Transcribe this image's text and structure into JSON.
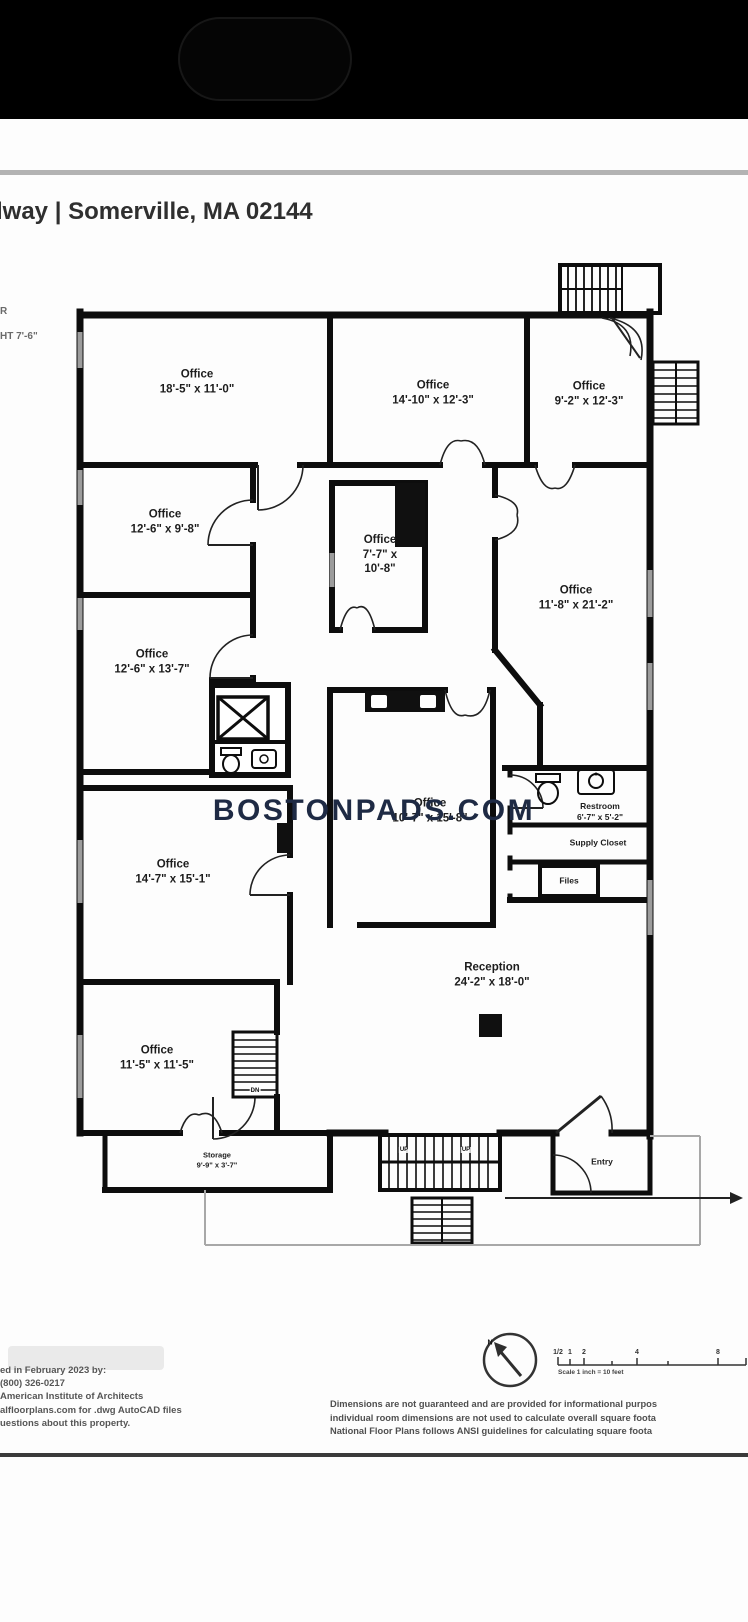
{
  "header": {
    "title": "lway | Somerville, MA 02144",
    "side_note": [
      "R",
      "HT 7'-6\""
    ]
  },
  "watermark": {
    "text": "BOSTONPADS.COM",
    "color": "#1e2a44"
  },
  "rooms": {
    "office1": {
      "name": "Office",
      "dims": "18'-5\" x 11'-0\""
    },
    "office2": {
      "name": "Office",
      "dims": "14'-10\" x 12'-3\""
    },
    "office3": {
      "name": "Office",
      "dims": "9'-2\" x 12'-3\""
    },
    "office4": {
      "name": "Office",
      "dims": "12'-6\" x 9'-8\""
    },
    "office5": {
      "name": "Office",
      "dims_l1": "7'-7\" x",
      "dims_l2": "10'-8\""
    },
    "office6": {
      "name": "Office",
      "dims": "11'-8\" x 21'-2\""
    },
    "office7": {
      "name": "Office",
      "dims": "12'-6\" x 13'-7\""
    },
    "office8": {
      "name": "Office",
      "dims": "14'-7\" x 15'-1\""
    },
    "office9": {
      "name": "Office",
      "dims": "10'-7\" x 15'-8\""
    },
    "restroom": {
      "name": "Restroom",
      "dims": "6'-7\" x 5'-2\""
    },
    "supply_closet": {
      "name": "Supply Closet"
    },
    "files": {
      "name": "Files"
    },
    "reception": {
      "name": "Reception",
      "dims": "24'-2\" x 18'-0\""
    },
    "office14": {
      "name": "Office",
      "dims": "11'-5\" x 11'-5\""
    },
    "storage": {
      "name": "Storage",
      "dims": "9'-9\" x 3'-7\""
    },
    "entry": {
      "name": "Entry"
    }
  },
  "plan_labels": {
    "up": "UP",
    "dn": "DN",
    "north": "N"
  },
  "footer": {
    "left_lines": [
      "ed in February 2023 by:",
      "(800) 326-0217",
      "American Institute of Architects",
      "alfloorplans.com for .dwg AutoCAD files",
      "uestions about this property."
    ],
    "scale": {
      "ticks": [
        "1/2",
        "1",
        "2",
        "4",
        "8"
      ],
      "label": "Scale 1 inch = 10 feet"
    },
    "right_lines": [
      "Dimensions are not guaranteed and are provided for informational purpos",
      "individual room dimensions are not used to calculate overall square foota",
      "National Floor Plans follows ANSI guidelines for calculating square foota"
    ]
  }
}
